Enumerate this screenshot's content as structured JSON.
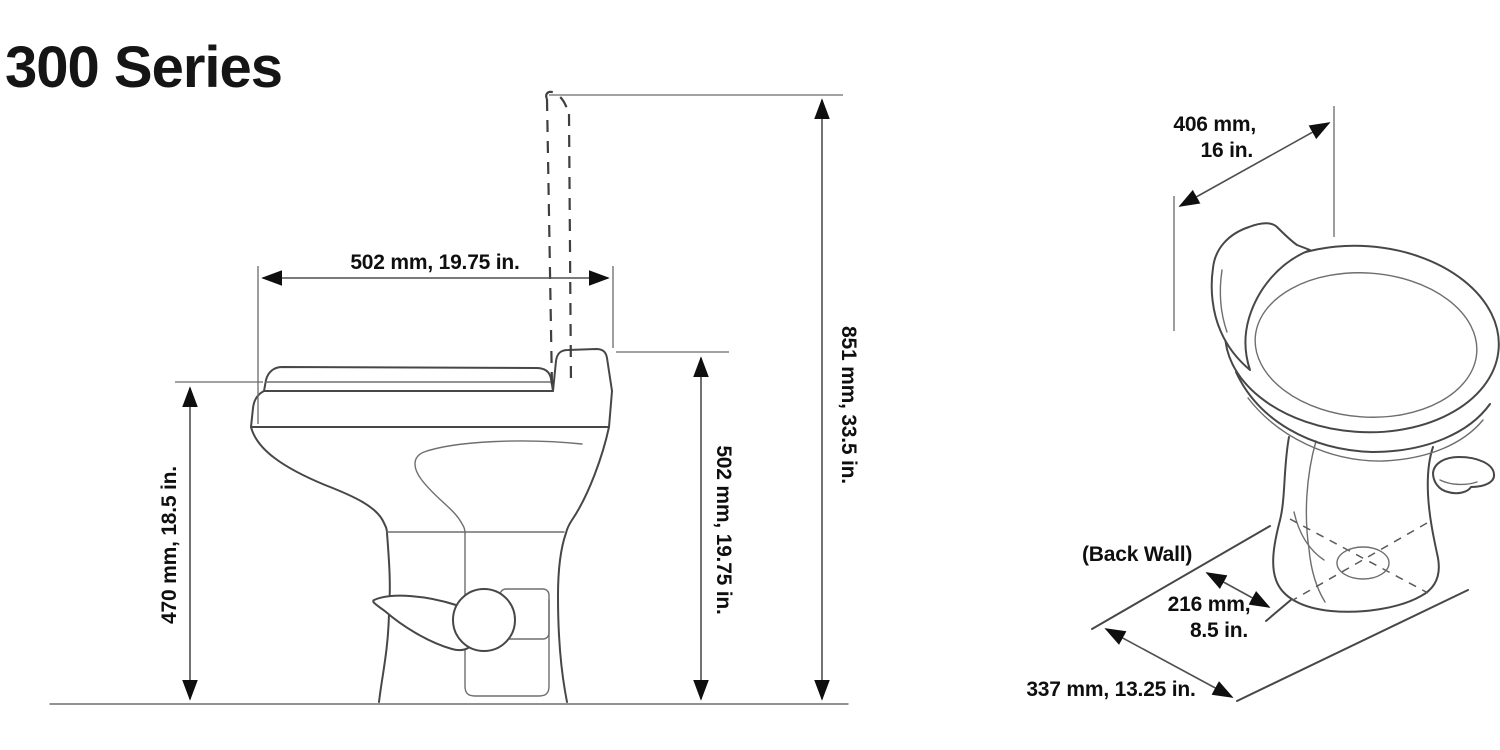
{
  "title": "300 Series",
  "colors": {
    "background": "#ffffff",
    "drawing_line": "#474747",
    "dimension_line": "#4f4f4f",
    "ink": "#0f0f0f"
  },
  "side_view": {
    "dimensions": {
      "seat_depth": "502 mm, 19.75 in.",
      "bowl_height": "470 mm, 18.5 in.",
      "seat_height": "502 mm, 19.75 in.",
      "lid_raised_height": "851 mm, 33.5 in."
    }
  },
  "perspective_view": {
    "back_wall_label": "(Back Wall)",
    "dimensions": {
      "width_line1": "406 mm,",
      "width_line2": "16 in.",
      "drain_offset_line1": "216 mm,",
      "drain_offset_line2": "8.5 in.",
      "base_depth": "337 mm, 13.25 in."
    }
  }
}
